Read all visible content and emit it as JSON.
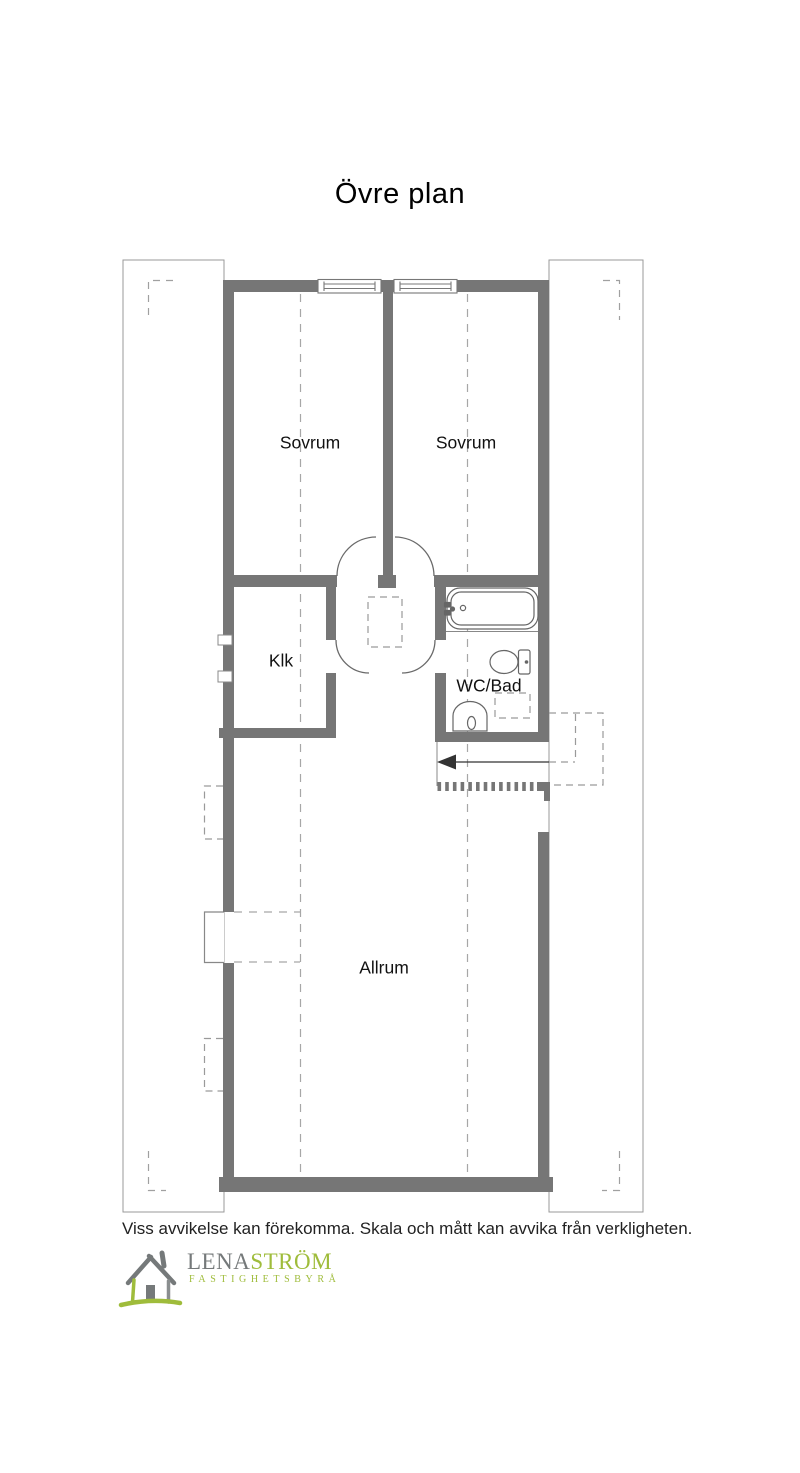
{
  "title": "Övre plan",
  "rooms": {
    "sovrum_left": "Sovrum",
    "sovrum_right": "Sovrum",
    "klk": "Klk",
    "wc_bad": "WC/Bad",
    "allrum": "Allrum"
  },
  "disclaimer": "Viss avvikelse kan förekomma. Skala och mått kan avvika från verkligheten.",
  "logo": {
    "name_primary": "LENA",
    "name_secondary": "STRÖM",
    "tagline": "FASTIGHETSBYRÅ"
  },
  "colors": {
    "wall_gray": "#767676",
    "fixture_stroke": "#666666",
    "dashed_gray": "#a0a0a0",
    "logo_green": "#9fbc3b",
    "logo_gray": "#75797a",
    "text": "#1a1a1a"
  }
}
